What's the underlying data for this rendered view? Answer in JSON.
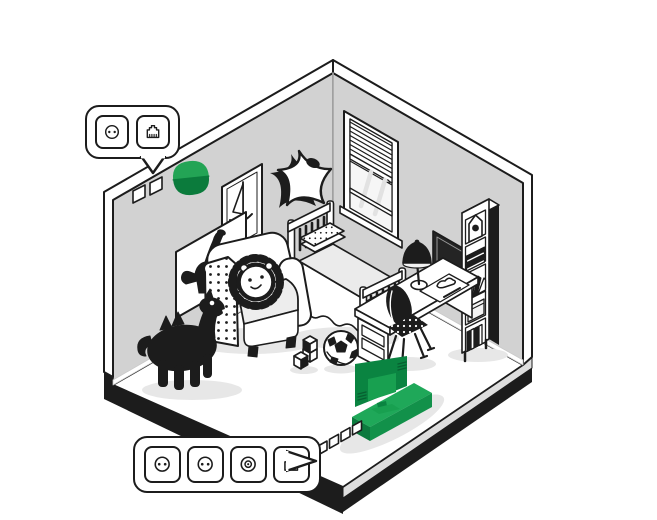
{
  "illustration": {
    "description": "Isometric illustration of a child's bedroom with callouts showing wall and floor socket groups",
    "room_objects": [
      "window with blinds",
      "bed with pillow and blanket",
      "armchair",
      "lion pillow",
      "rocking dinosaur toy",
      "sailboat picture",
      "dinosaur picture",
      "star wall decoration",
      "green night light",
      "desk with drawers",
      "desk lamp",
      "drawing paper with pencil",
      "desk chair",
      "bookshelf with birdhouse books and box",
      "dark wall board",
      "green tv",
      "green tv bench",
      "soccer ball",
      "toy blocks",
      "two wall sockets",
      "four floor sockets"
    ]
  },
  "callouts": {
    "wall": {
      "icons": [
        {
          "type": "power-socket",
          "label": "power socket"
        },
        {
          "type": "ethernet-socket",
          "label": "ethernet socket"
        }
      ]
    },
    "floor": {
      "icons": [
        {
          "type": "power-socket",
          "label": "power socket"
        },
        {
          "type": "power-socket",
          "label": "power socket"
        },
        {
          "type": "coax-socket",
          "label": "tv coax socket"
        },
        {
          "type": "ethernet-socket",
          "label": "ethernet socket"
        }
      ]
    }
  },
  "colors": {
    "outline": "#1C1C1C",
    "wall_gray": "#D2D2D2",
    "floor_white": "#FFFFFF",
    "platform_black": "#1C1C1C",
    "slab_gray": "#DEDEDE",
    "shadow_gray": "#E7E7E7",
    "accent_green_top": "#1FA859",
    "accent_green_side": "#12914A",
    "accent_green_dark": "#0C7A3E",
    "tv_green": "#0A8441",
    "tv_screen_green": "#18A050",
    "tv_vent_green": "#075F30",
    "night_light_green": "#23A455",
    "night_light_dark_green": "#0B7B3C"
  }
}
